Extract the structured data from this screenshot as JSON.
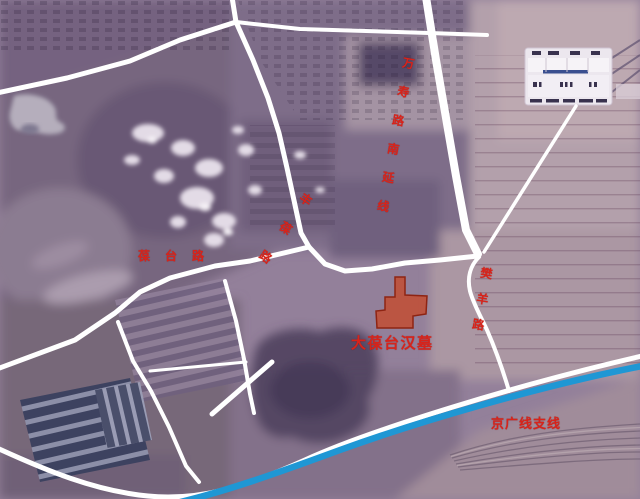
{
  "map": {
    "labels": {
      "wanshou_road": "万寿路南延线",
      "baotai_road": "葆台路",
      "fengbao_road": "丰葆路",
      "fanyang_road": "樊羊路",
      "jingguang_branch": "京广线支线",
      "site": "大葆台汉墓"
    },
    "colors": {
      "road_white": "#ffffff",
      "railway_blue": "#1f97d4",
      "label_red": "#d8231a",
      "site_fill": "#c04f36",
      "site_stroke": "#8e2413"
    }
  }
}
